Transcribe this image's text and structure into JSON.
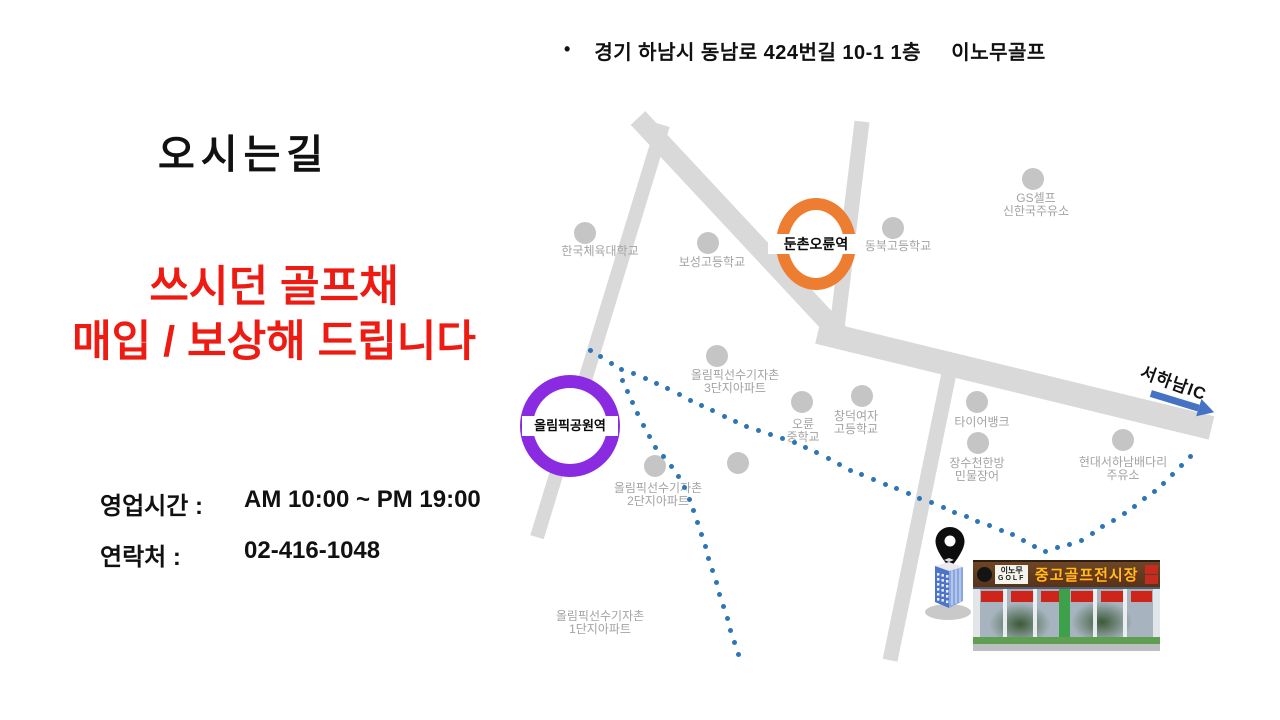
{
  "page": {
    "bullet_glyph": "•",
    "address": "경기 하남시 동남로 424번길 10-1 1층     이노무골프",
    "title": "오시는길",
    "promo": {
      "line1": "쓰시던 골프채",
      "line2": "매입 / 보상해 드립니다"
    },
    "hours": {
      "label": "영업시간 :",
      "value": "AM 10:00 ~ PM 19:00"
    },
    "contact": {
      "label": "연락처 :",
      "value": "02-416-1048"
    }
  },
  "colors": {
    "promo_red": "#ee1b13",
    "route_blue": "#2e75b6",
    "arrow_blue": "#4472c4",
    "road_gray": "#d9d9d9",
    "landmark_dot_gray": "#c5c5c5",
    "landmark_label_gray": "#a3a3a3",
    "station_orange": "#ed7d31",
    "station_purple": "#8a2be2"
  },
  "map": {
    "stations": [
      {
        "name": "둔촌오륜역",
        "x": 816,
        "y": 244,
        "rx": 40,
        "ry": 46,
        "stroke": 12,
        "color": "#ed7d31",
        "fs": 14
      },
      {
        "name": "올림픽공원역",
        "x": 570,
        "y": 426,
        "rx": 50,
        "ry": 51,
        "stroke": 13,
        "color": "#8a2be2",
        "fs": 13
      }
    ],
    "landmarks": [
      {
        "lines": [
          "한국체육대학교"
        ],
        "cx": 600,
        "ty": 245,
        "dot": [
          585,
          233
        ]
      },
      {
        "lines": [
          "보성고등학교"
        ],
        "cx": 712,
        "ty": 256,
        "dot": [
          708,
          243
        ]
      },
      {
        "lines": [
          "동북고등학교"
        ],
        "cx": 898,
        "ty": 240,
        "dot": [
          893,
          228
        ]
      },
      {
        "lines": [
          "GS셀프",
          "신한국주유소"
        ],
        "cx": 1036,
        "ty": 192,
        "dot": [
          1033,
          179
        ]
      },
      {
        "lines": [
          "올림픽선수기자촌",
          "3단지아파트"
        ],
        "cx": 735,
        "ty": 369,
        "dot": [
          717,
          356
        ]
      },
      {
        "lines": [
          "오륜",
          "중학교"
        ],
        "cx": 803,
        "ty": 418,
        "dot": [
          802,
          402
        ]
      },
      {
        "lines": [
          "창덕여자",
          "고등학교"
        ],
        "cx": 856,
        "ty": 410,
        "dot": [
          862,
          396
        ]
      },
      {
        "lines": [
          "타이어뱅크"
        ],
        "cx": 982,
        "ty": 416,
        "dot": [
          977,
          402
        ]
      },
      {
        "lines": [
          "장수천한방",
          "민물장어"
        ],
        "cx": 977,
        "ty": 457,
        "dot": [
          978,
          443
        ]
      },
      {
        "lines": [
          "현대서하남배다리",
          "주유소"
        ],
        "cx": 1123,
        "ty": 456,
        "dot": [
          1123,
          440
        ]
      },
      {
        "lines": [
          "올림픽선수기자촌",
          "2단지아파트"
        ],
        "cx": 658,
        "ty": 482,
        "dot": [
          655,
          466
        ]
      },
      {
        "lines": [
          "올림픽선수기자촌",
          "1단지아파트"
        ],
        "cx": 600,
        "ty": 610,
        "dot": null
      }
    ],
    "extra_dots": [
      [
        738,
        463
      ]
    ],
    "route_main": [
      [
        590,
        350
      ],
      [
        620,
        369
      ],
      [
        650,
        380
      ],
      [
        700,
        405
      ],
      [
        750,
        428
      ],
      [
        800,
        444
      ],
      [
        850,
        470
      ],
      [
        900,
        490
      ],
      [
        957,
        513
      ],
      [
        1013,
        535
      ],
      [
        1045,
        552
      ],
      [
        1080,
        541
      ],
      [
        1125,
        513
      ],
      [
        1160,
        487
      ],
      [
        1192,
        455
      ]
    ],
    "route_branch": [
      [
        622,
        380
      ],
      [
        633,
        404
      ],
      [
        644,
        426
      ],
      [
        656,
        448
      ],
      [
        670,
        465
      ],
      [
        682,
        482
      ],
      [
        692,
        505
      ],
      [
        700,
        530
      ],
      [
        708,
        556
      ],
      [
        716,
        582
      ],
      [
        724,
        608
      ],
      [
        732,
        634
      ],
      [
        739,
        657
      ]
    ],
    "highway_label": "서하남IC",
    "photo_sign": {
      "logo_top": "이노무",
      "logo_bottom": "GOLF",
      "main": "중고골프전시장"
    }
  }
}
